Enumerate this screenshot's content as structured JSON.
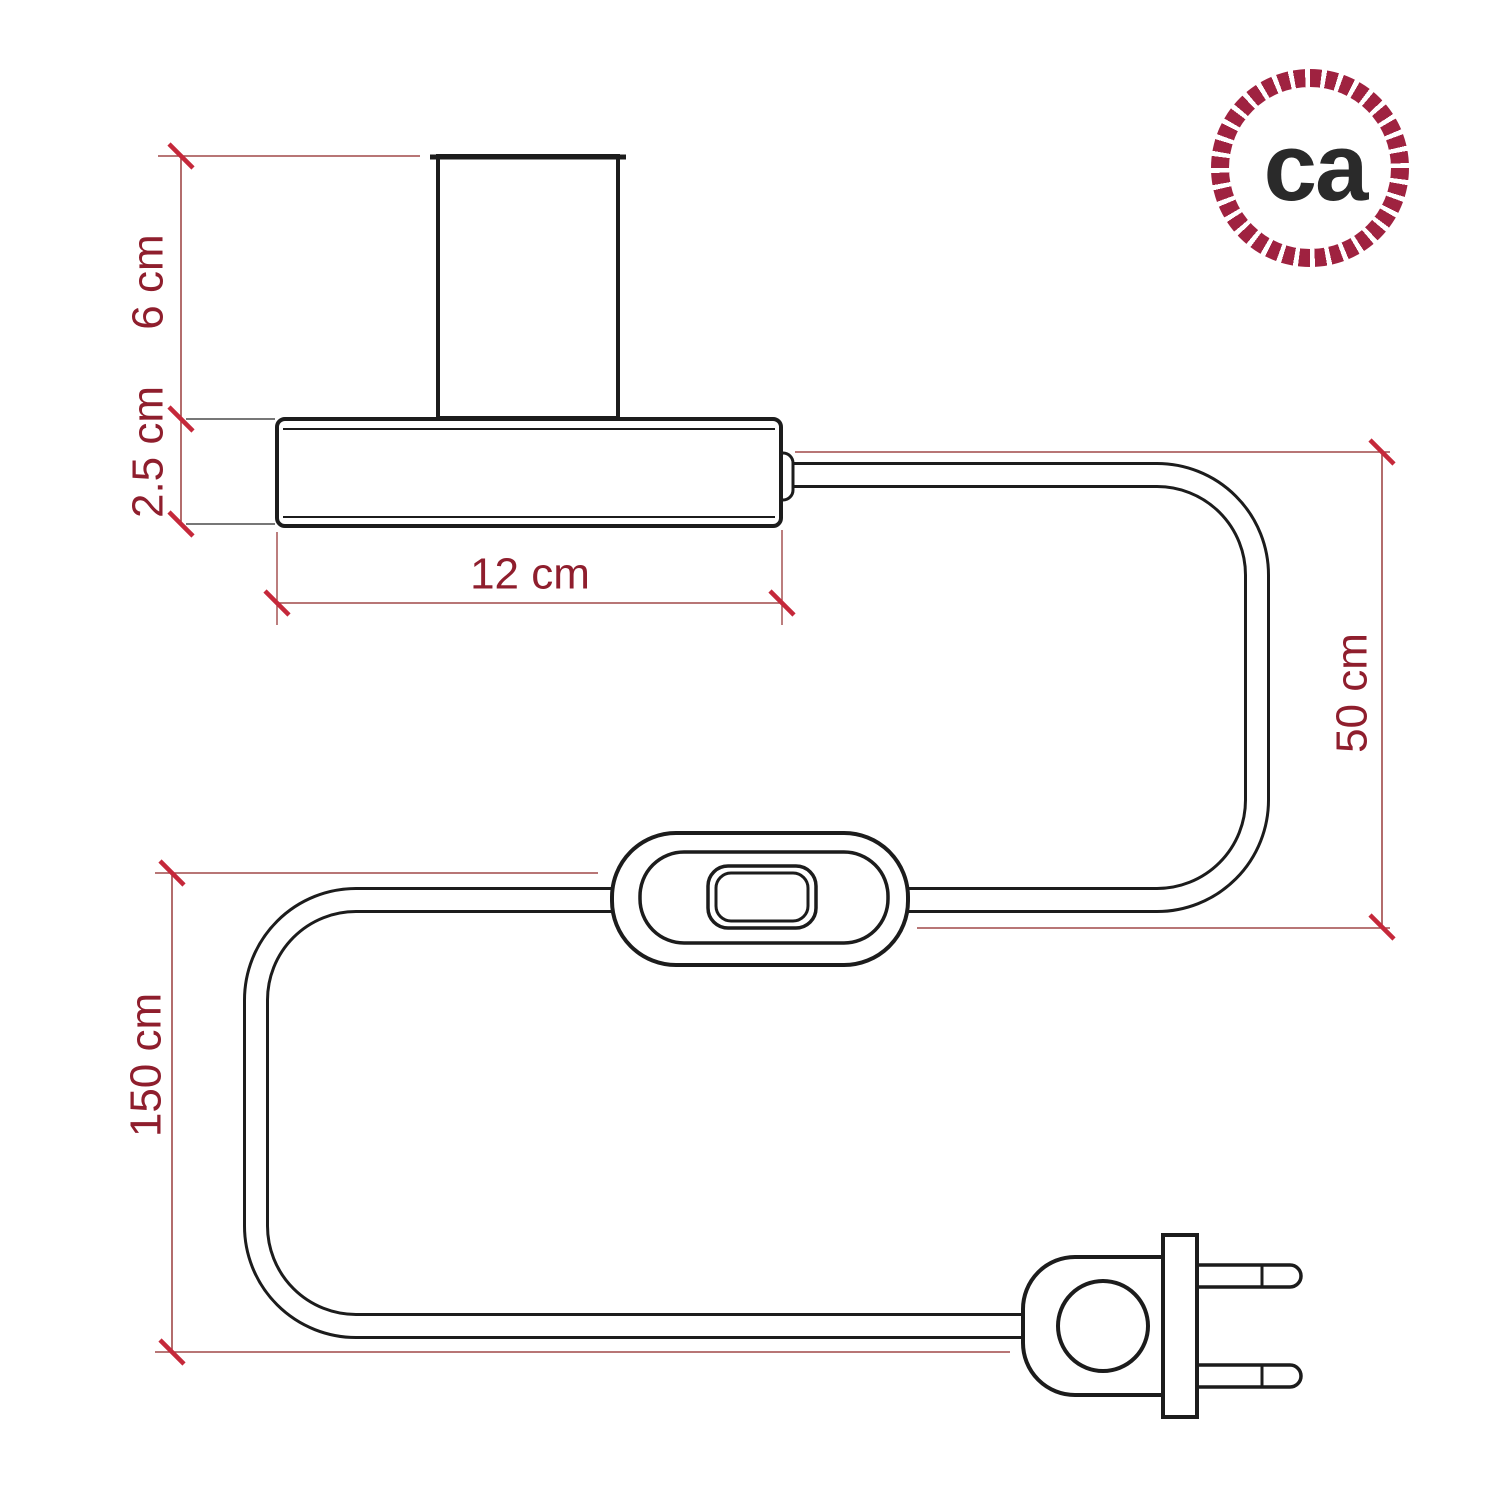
{
  "drawing": {
    "title": "table-lamp-dimension-diagram",
    "labels": {
      "socket_height": "6 cm",
      "base_height": "2.5 cm",
      "base_width": "12 cm",
      "cable_right": "50 cm",
      "cable_left": "150 cm"
    }
  },
  "logo": {
    "text": "ca"
  },
  "colors": {
    "outline": "#1c1c1c",
    "dimension_line": "#a04848",
    "tick": "#c5283a",
    "dimension_label": "#8f1e2d",
    "logo_ring": "#9f2240",
    "logo_text": "#2a2a2a",
    "background": "#ffffff"
  }
}
